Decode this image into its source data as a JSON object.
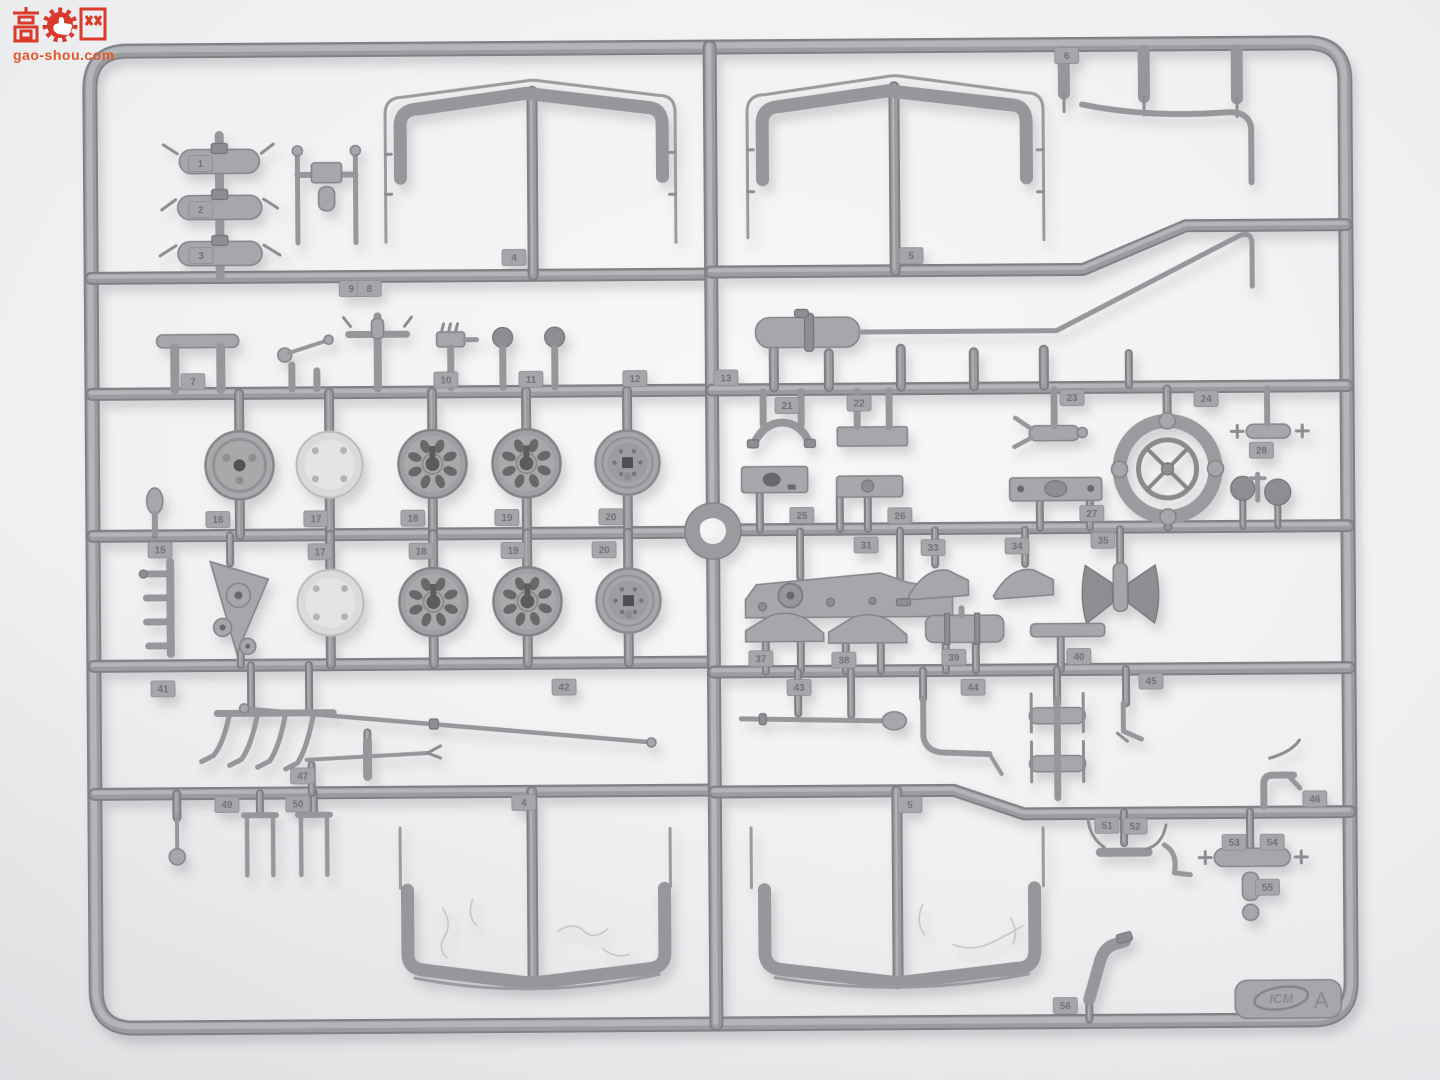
{
  "scene": {
    "description": "Grey injection-moulded plastic model-kit sprue (parts tree) photographed on a white background",
    "background_color": "#eef0f1",
    "plastic_color": "#98999c"
  },
  "watermark": {
    "char_left": "高",
    "char_right": "网",
    "icon": "thumb-up-gear-icon",
    "site": "gao-shou.com",
    "red": "#d93a2b",
    "orange": "#e2572a"
  },
  "sprue": {
    "brand": "ICM",
    "letter": "A",
    "part_tags": [
      {
        "n": "1",
        "x": 203,
        "y": 160
      },
      {
        "n": "2",
        "x": 203,
        "y": 206
      },
      {
        "n": "3",
        "x": 203,
        "y": 252
      },
      {
        "n": "4",
        "x": 516,
        "y": 256
      },
      {
        "n": "5",
        "x": 913,
        "y": 257
      },
      {
        "n": "6",
        "x": 1070,
        "y": 58
      },
      {
        "n": "9",
        "x": 353,
        "y": 286
      },
      {
        "n": "8",
        "x": 371,
        "y": 286
      },
      {
        "n": "7",
        "x": 194,
        "y": 378
      },
      {
        "n": "10",
        "x": 447,
        "y": 378
      },
      {
        "n": "11",
        "x": 532,
        "y": 378
      },
      {
        "n": "12",
        "x": 636,
        "y": 378
      },
      {
        "n": "13",
        "x": 727,
        "y": 378
      },
      {
        "n": "15",
        "x": 160,
        "y": 546
      },
      {
        "n": "16",
        "x": 218,
        "y": 516
      },
      {
        "n": "17",
        "x": 316,
        "y": 516
      },
      {
        "n": "18",
        "x": 413,
        "y": 516
      },
      {
        "n": "19",
        "x": 507,
        "y": 516
      },
      {
        "n": "20",
        "x": 611,
        "y": 516
      },
      {
        "n": "17",
        "x": 320,
        "y": 549
      },
      {
        "n": "18",
        "x": 421,
        "y": 549
      },
      {
        "n": "19",
        "x": 513,
        "y": 549
      },
      {
        "n": "20",
        "x": 604,
        "y": 549
      },
      {
        "n": "21",
        "x": 788,
        "y": 406
      },
      {
        "n": "22",
        "x": 860,
        "y": 404
      },
      {
        "n": "23",
        "x": 1073,
        "y": 400
      },
      {
        "n": "24",
        "x": 1207,
        "y": 402
      },
      {
        "n": "25",
        "x": 802,
        "y": 516
      },
      {
        "n": "26",
        "x": 900,
        "y": 517
      },
      {
        "n": "27",
        "x": 1092,
        "y": 516
      },
      {
        "n": "28",
        "x": 1262,
        "y": 454
      },
      {
        "n": "31",
        "x": 866,
        "y": 546
      },
      {
        "n": "33",
        "x": 933,
        "y": 549
      },
      {
        "n": "34",
        "x": 1017,
        "y": 548
      },
      {
        "n": "35",
        "x": 1103,
        "y": 543
      },
      {
        "n": "37",
        "x": 760,
        "y": 659
      },
      {
        "n": "38",
        "x": 843,
        "y": 661
      },
      {
        "n": "39",
        "x": 953,
        "y": 659
      },
      {
        "n": "40",
        "x": 1078,
        "y": 659
      },
      {
        "n": "41",
        "x": 162,
        "y": 685
      },
      {
        "n": "42",
        "x": 563,
        "y": 686
      },
      {
        "n": "43",
        "x": 798,
        "y": 688
      },
      {
        "n": "44",
        "x": 972,
        "y": 689
      },
      {
        "n": "45",
        "x": 1150,
        "y": 684
      },
      {
        "n": "46",
        "x": 1313,
        "y": 803
      },
      {
        "n": "47",
        "x": 301,
        "y": 773
      },
      {
        "n": "49",
        "x": 225,
        "y": 801
      },
      {
        "n": "50",
        "x": 296,
        "y": 801
      },
      {
        "n": "4",
        "x": 522,
        "y": 801
      },
      {
        "n": "5",
        "x": 908,
        "y": 806
      },
      {
        "n": "51",
        "x": 1105,
        "y": 828
      },
      {
        "n": "52",
        "x": 1133,
        "y": 829
      },
      {
        "n": "53",
        "x": 1232,
        "y": 846
      },
      {
        "n": "54",
        "x": 1270,
        "y": 846
      },
      {
        "n": "55",
        "x": 1265,
        "y": 891
      },
      {
        "n": "56",
        "x": 1062,
        "y": 1008
      }
    ]
  }
}
